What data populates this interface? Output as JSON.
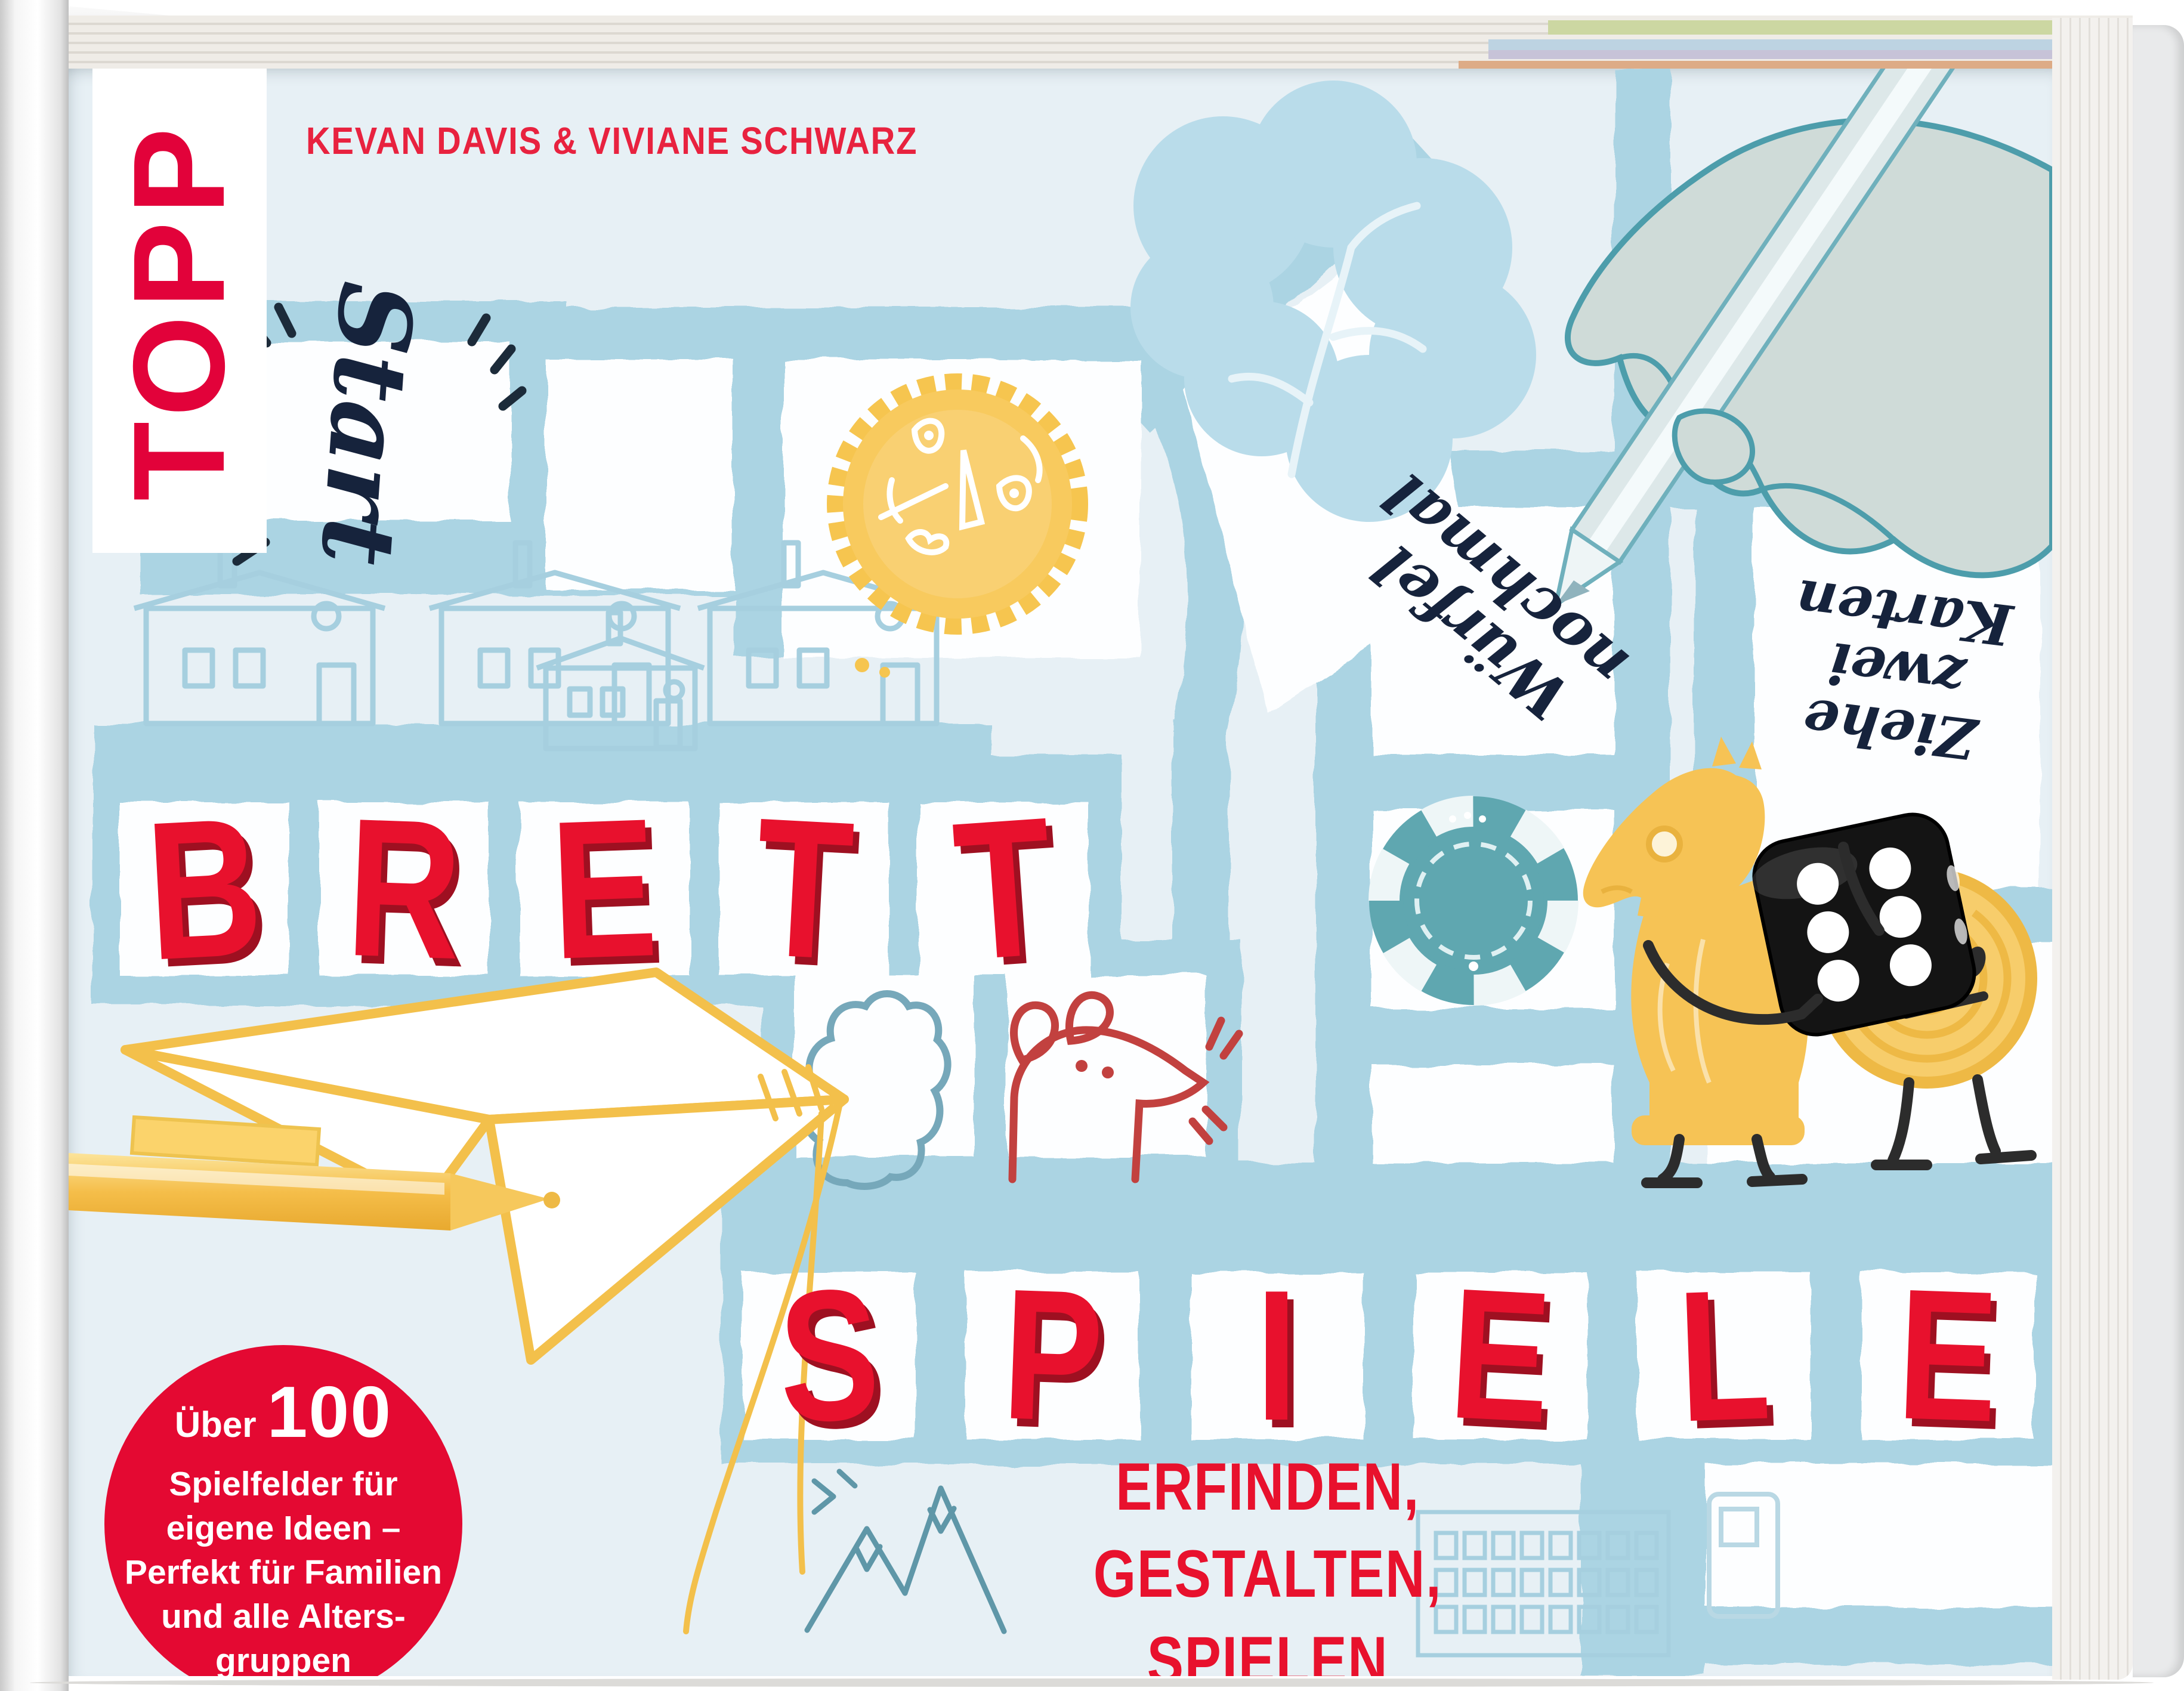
{
  "cover": {
    "publisher_logo": "TOPP",
    "authors": "KEVAN DAVIS & VIVIANE SCHWARZ"
  },
  "title": {
    "brett": [
      "B",
      "R",
      "E",
      "T",
      "T"
    ],
    "spiele": [
      "S",
      "P",
      "I",
      "E",
      "L",
      "E"
    ]
  },
  "subtitle": {
    "line1": "ERFINDEN,",
    "line2": "GESTALTEN,",
    "line3": "SPIELEN"
  },
  "badge": {
    "line1_small": "Über",
    "line1_big": "100",
    "line2": "Spielfelder für",
    "line3": "eigene Ideen –",
    "line4": "Perfekt für Familien",
    "line5": "und alle Alters-",
    "line6": "gruppen"
  },
  "board": {
    "start": "Start",
    "wuerfel_line1": "Würfel",
    "wuerfel_line2": "nochmal",
    "ziehe_line1": "Ziehe",
    "ziehe_line2": "zwei",
    "ziehe_line3": "Karten"
  },
  "colors": {
    "cover_background": "#e7f0f5",
    "board_path_blue": "#abd4e3",
    "title_red": "#e8112d",
    "title_shadow_red": "#9e1021",
    "badge_red": "#e40932",
    "accent_yellow": "#f6c54f",
    "ink_navy": "#1c2b3a",
    "teal_outline": "#4f9fae",
    "chip_teal": "#5fa7b0",
    "author_red": "#e8223f"
  },
  "icons": [
    "bottle-cap-sun-icon",
    "poker-chip-icon",
    "black-die-icon",
    "chess-knight-character",
    "coin-character",
    "hand-with-pencil-icon",
    "paper-plane-pen-icon",
    "houses-sketch-icon",
    "tree-icon",
    "mouse-sketch-icon",
    "cloud-sketch-icon",
    "mountains-sketch-icon",
    "apartment-building-icon",
    "start-field-icon"
  ]
}
